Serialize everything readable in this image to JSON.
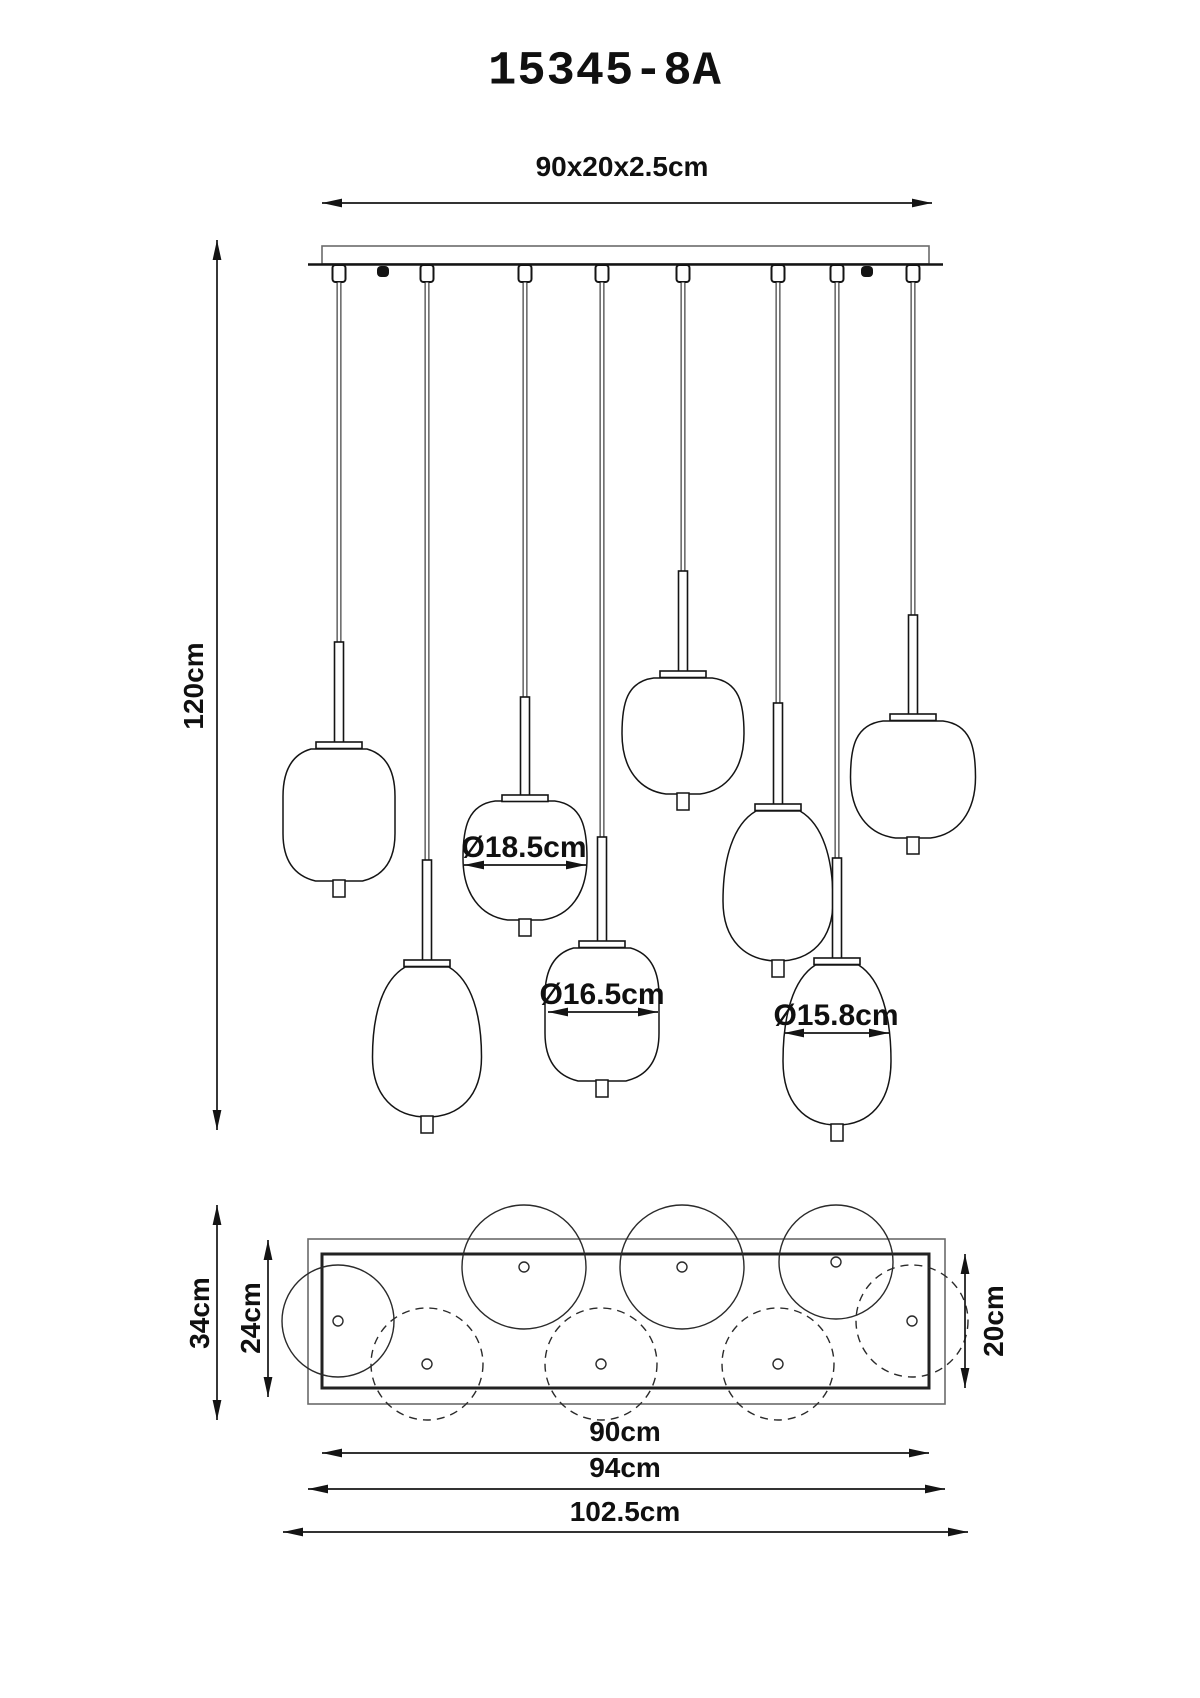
{
  "title": "15345-8A",
  "drawing": {
    "canopy_size_label": "90x20x2.5cm",
    "drop_length_label": "120cm",
    "shade_diameters": {
      "large": "Ø18.5cm",
      "medium": "Ø16.5cm",
      "small": "Ø15.8cm"
    },
    "plan_labels": {
      "total_depth": "34cm",
      "canopy_outer_depth": "24cm",
      "canopy_inner_depth": "20cm",
      "canopy_inner_width": "90cm",
      "canopy_outer_width": "94cm",
      "total_width": "102.5cm"
    }
  }
}
